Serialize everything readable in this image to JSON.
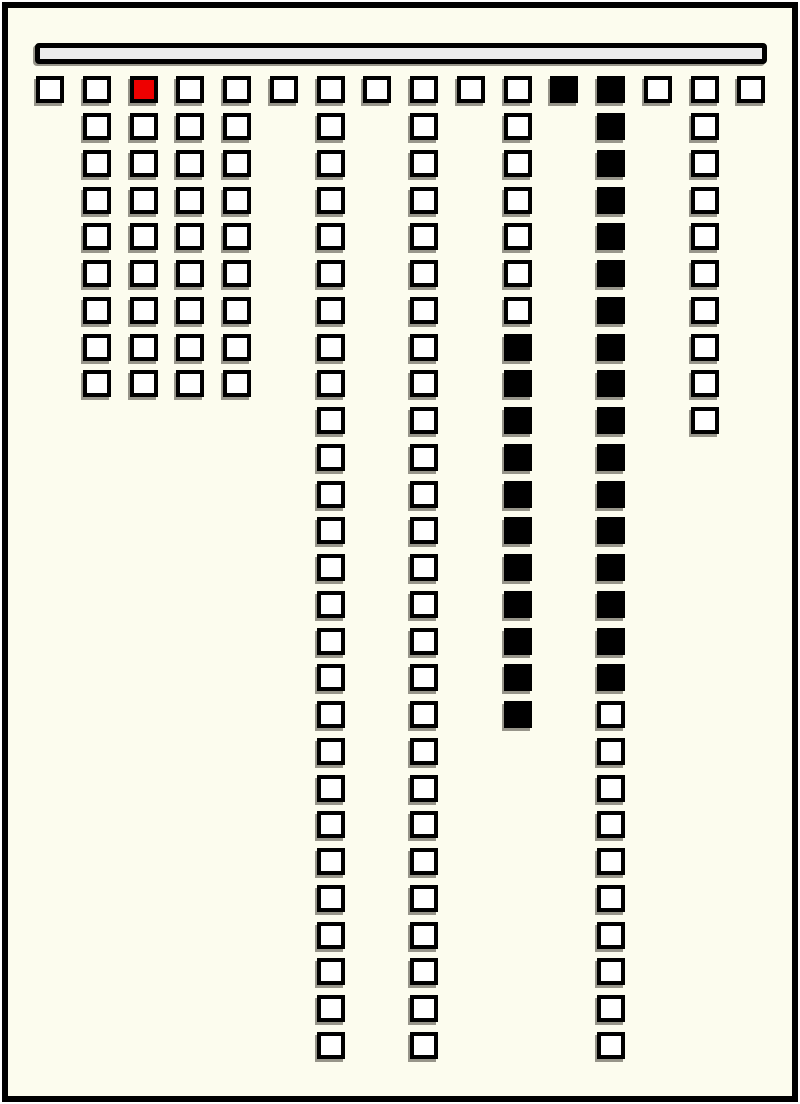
{
  "colors": {
    "page_background": "#FCFCEE",
    "frame_border": "#000000",
    "cell_border": "#000000",
    "cell_empty_fill": "#FFFFFF",
    "cell_filled_fill": "#000000",
    "cell_red_fill": "#EE0000",
    "top_bar_fill": "#ECECEC",
    "shadow": "#97958A"
  },
  "board": {
    "columns_total": 16,
    "rows_total": 27,
    "legend": {
      "o": "empty",
      "x": "filled-black",
      "r": "filled-red"
    },
    "columns": [
      {
        "index": 1,
        "pattern": "o"
      },
      {
        "index": 2,
        "pattern": "ooooooooo"
      },
      {
        "index": 3,
        "pattern": "roooooooo"
      },
      {
        "index": 4,
        "pattern": "ooooooooo"
      },
      {
        "index": 5,
        "pattern": "ooooooooo"
      },
      {
        "index": 6,
        "pattern": "o"
      },
      {
        "index": 7,
        "pattern": "ooooooooooooooooooooooooooo"
      },
      {
        "index": 8,
        "pattern": "o"
      },
      {
        "index": 9,
        "pattern": "ooooooooooooooooooooooooooo"
      },
      {
        "index": 10,
        "pattern": "o"
      },
      {
        "index": 11,
        "pattern": "oooooooxxxxxxxxxxx"
      },
      {
        "index": 12,
        "pattern": "x"
      },
      {
        "index": 13,
        "pattern": "xxxxxxxxxxxxxxxxxoooooooooo"
      },
      {
        "index": 14,
        "pattern": "o"
      },
      {
        "index": 15,
        "pattern": "oooooooooo"
      },
      {
        "index": 16,
        "pattern": "o"
      }
    ]
  }
}
